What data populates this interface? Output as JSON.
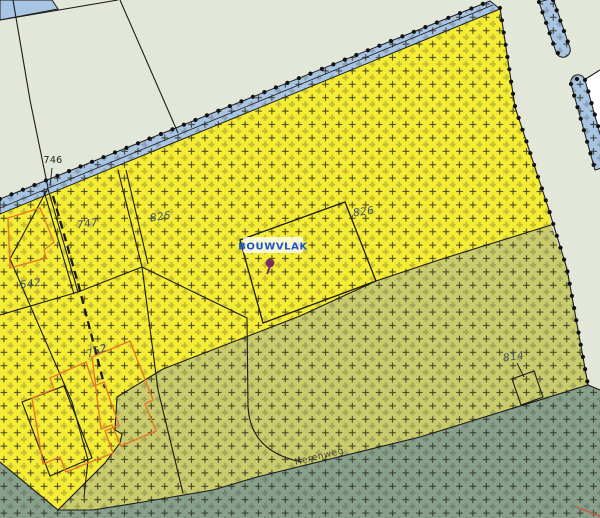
{
  "map": {
    "title": "cadastral zoning map detail",
    "labels": {
      "parcels": [
        {
          "id": "746",
          "text": "746"
        },
        {
          "id": "747",
          "text": "747"
        },
        {
          "id": "825",
          "text": "825"
        },
        {
          "id": "826",
          "text": "826"
        },
        {
          "id": "542",
          "text": "542"
        },
        {
          "id": "752",
          "text": "752"
        },
        {
          "id": "814",
          "text": "814"
        }
      ],
      "bouwvlak": "BOUWVLAK",
      "street": "Herenweg"
    },
    "colors": {
      "background_parcels": "#e2e7d9",
      "zone_yellow": "#f5ec35",
      "zone_olive": "#c9cc6d",
      "zone_road_verge": "#87a08c",
      "water_ditch_blue": "#a9c5e4",
      "white_parcel": "#ffffff",
      "boundary_line": "#1b1b1b",
      "plan_boundary_dots": "#111111",
      "plus_pattern": "#2e2e1e",
      "parcel_label_blue": "#3f4c70",
      "parcel_label_black": "#1f1f1f",
      "parcel_label_grey": "#4a5668",
      "bouwvlak_text": "#1d55cb",
      "bouwvlak_bg": "rgba(255,255,255,0.78)",
      "building_outline_orange": "#e67828",
      "marker_purple": "#7c2f5f",
      "red_line": "#c4604a"
    }
  }
}
